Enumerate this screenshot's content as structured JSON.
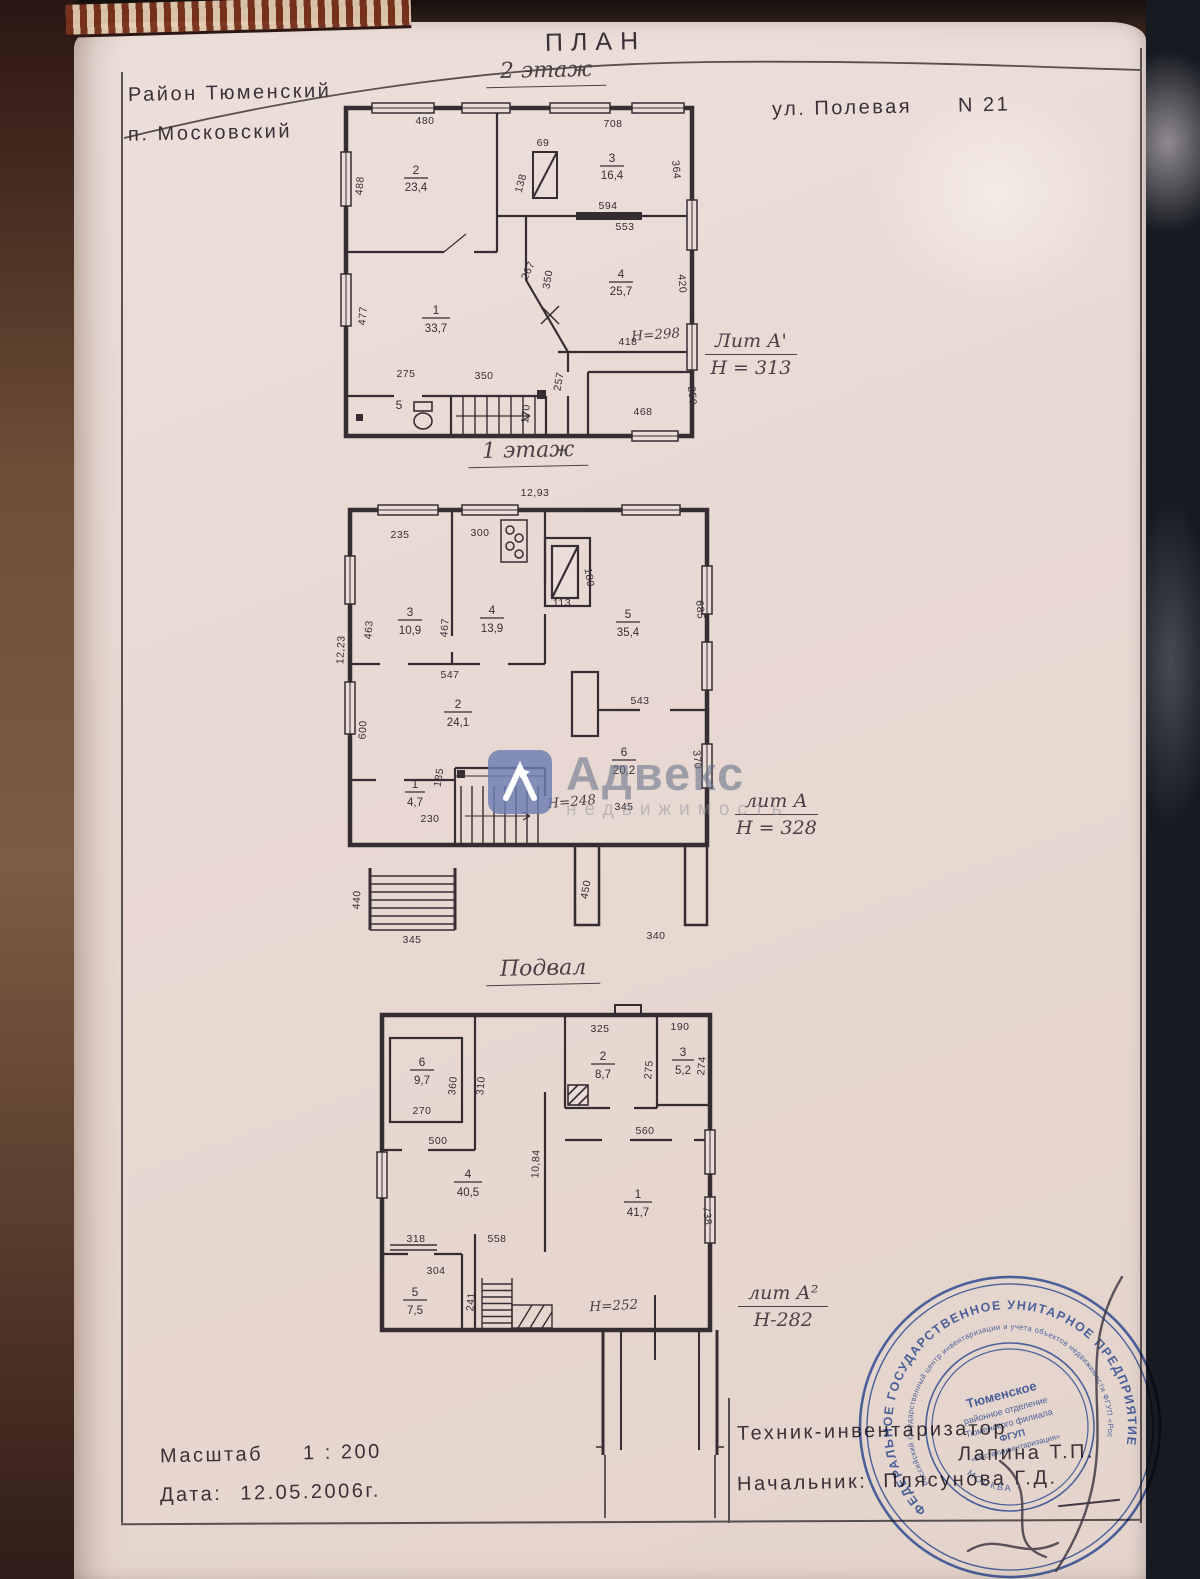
{
  "page": {
    "title": "ПЛАН",
    "district1": "Район Тюменский",
    "district2": "п. Московский",
    "street": "ул. Полевая",
    "house": "N 21"
  },
  "watermark": {
    "brand": "Адвекс",
    "sub": "недвижимость"
  },
  "floor2": {
    "label": "2 этаж",
    "lit": "Лит А'",
    "lit_h": "Н = 313",
    "h_note": "Н=298",
    "rooms": [
      {
        "n": "2",
        "a": "23,4"
      },
      {
        "n": "3",
        "a": "16,4"
      },
      {
        "n": "4",
        "a": "25,7"
      },
      {
        "n": "1",
        "a": "33,7"
      },
      {
        "n": "5",
        "a": ""
      }
    ],
    "dims": [
      "480",
      "708",
      "488",
      "69",
      "138",
      "364",
      "594",
      "553",
      "350",
      "267",
      "420",
      "477",
      "418",
      "275",
      "350",
      "257",
      "170",
      "468",
      "250"
    ]
  },
  "floor1": {
    "label": "1 этаж",
    "lit": "лит А",
    "lit_h": "Н = 328",
    "h_note": "Н=248",
    "rooms": [
      {
        "n": "3",
        "a": "10,9"
      },
      {
        "n": "4",
        "a": "13,9"
      },
      {
        "n": "5",
        "a": "35,4"
      },
      {
        "n": "2",
        "a": "24,1"
      },
      {
        "n": "1",
        "a": "4,7"
      },
      {
        "n": "6",
        "a": "20,2"
      }
    ],
    "dims": [
      "12,93",
      "12,23",
      "235",
      "300",
      "463",
      "467",
      "113",
      "180",
      "685",
      "547",
      "600",
      "543",
      "370",
      "185",
      "230",
      "345",
      "440",
      "345",
      "450",
      "340"
    ]
  },
  "basement": {
    "label": "Подвал",
    "lit": "лит А²",
    "lit_h": "Н-282",
    "h_note": "Н=252",
    "rooms": [
      {
        "n": "6",
        "a": "9,7"
      },
      {
        "n": "2",
        "a": "8,7"
      },
      {
        "n": "3",
        "a": "5,2"
      },
      {
        "n": "4",
        "a": "40,5"
      },
      {
        "n": "1",
        "a": "41,7"
      },
      {
        "n": "5",
        "a": "7,5"
      }
    ],
    "dims": [
      "325",
      "190",
      "360",
      "310",
      "270",
      "500",
      "560",
      "275",
      "274",
      "10,84",
      "558",
      "318",
      "304",
      "241",
      "738"
    ]
  },
  "stamp": {
    "ring1": "ФЕДЕРАЛЬНОЕ ГОСУДАРСТВЕННОЕ УНИТАРНОЕ ПРЕДПРИЯТИЕ",
    "ring2": "Российский государственный центр инвентаризации и учета объектов недвижимости ФГУП «Ростехинвентаризация»",
    "c1": "Тюменское",
    "c2": "районное отделение",
    "c3": "Тюменского филиала",
    "c4": "ФГУП",
    "c5": "«Ростехинвентаризация»",
    "bottom": "· МОСКВА ·"
  },
  "footer": {
    "scale_label": "Масштаб",
    "scale_value": "1 : 200",
    "date_label": "Дата:",
    "date_value": "12.05.2006г.",
    "tech_label": "Техник-инвентаризатор",
    "tech_name": "Лапина Т.П.",
    "chief_label": "Начальник:",
    "chief_name": "Плясунова Г.Д."
  }
}
